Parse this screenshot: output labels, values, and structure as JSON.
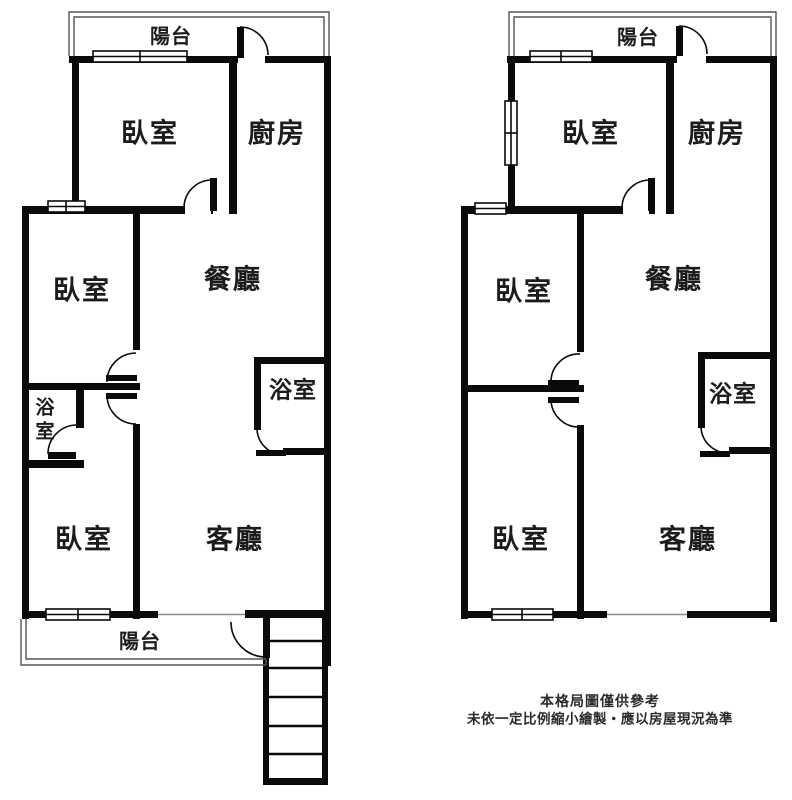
{
  "left_plan": {
    "balcony_top": "陽台",
    "bedroom_top": "臥室",
    "kitchen": "廚房",
    "bedroom_mid": "臥室",
    "dining": "餐廳",
    "bathroom_small": "浴室",
    "bathroom": "浴室",
    "bedroom_bottom": "臥室",
    "living": "客廳",
    "balcony_bottom": "陽台"
  },
  "right_plan": {
    "balcony_top": "陽台",
    "bedroom_top": "臥室",
    "kitchen": "廚房",
    "bedroom_mid": "臥室",
    "dining": "餐廳",
    "bathroom": "浴室",
    "bedroom_bottom": "臥室",
    "living": "客廳"
  },
  "disclaimer": {
    "line1": "本格局圖僅供參考",
    "line2": "未依一定比例縮小繪製・應以房屋現況為準"
  },
  "colors": {
    "wall": "#0a0a0a",
    "railing": "#555555",
    "opening_line": "#8a8a8a",
    "text": "#1c1c1c"
  }
}
